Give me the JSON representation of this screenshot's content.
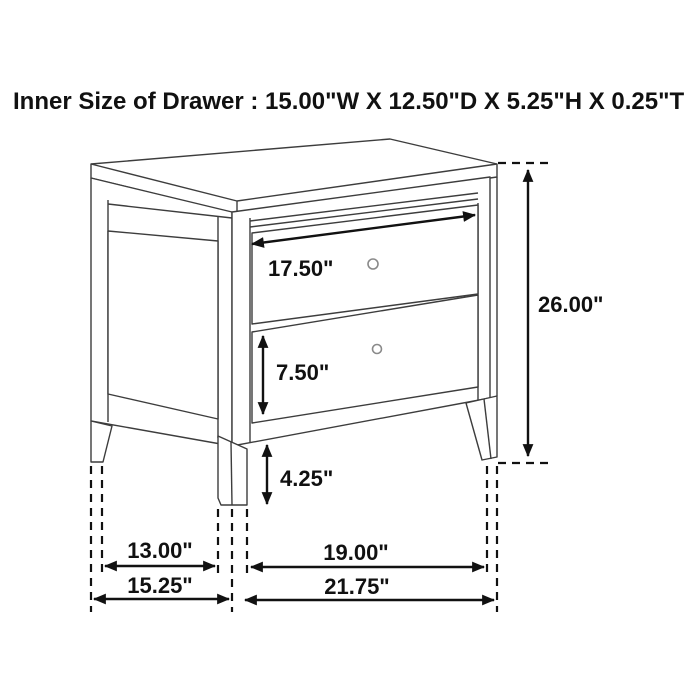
{
  "title": "Inner Size of Drawer : 15.00\"W X 12.50\"D X 5.25\"H X 0.25\"T",
  "inner_drawer_size": {
    "width": "15.00\"W",
    "depth": "12.50\"D",
    "height": "5.25\"H",
    "thickness": "0.25\"T"
  },
  "dimensions": {
    "drawer_opening_width": {
      "label": "17.50\""
    },
    "overall_height": {
      "label": "26.00\""
    },
    "bottom_drawer_height": {
      "label": "7.50\""
    },
    "floor_clearance": {
      "label": "4.25\""
    },
    "side_leg_span_inner": {
      "label": "13.00\""
    },
    "side_depth_overall": {
      "label": "15.25\""
    },
    "front_leg_span_inner": {
      "label": "19.00\""
    },
    "overall_width": {
      "label": "21.75\""
    }
  },
  "colors": {
    "background": "#ffffff",
    "dimension_lines": "#111111",
    "furniture_lines": "#3d3d3d",
    "knob": "#8a8a8a"
  }
}
